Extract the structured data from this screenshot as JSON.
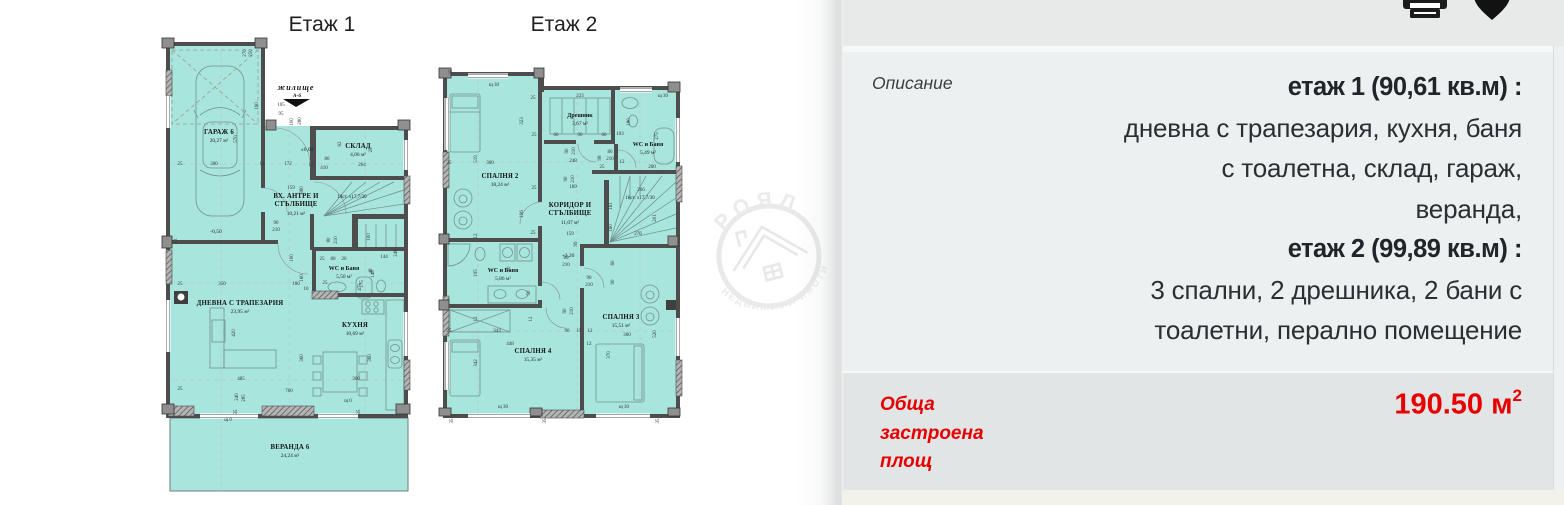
{
  "titles": {
    "floor1": "Етаж 1",
    "floor2": "Етаж 2"
  },
  "watermark": {
    "top_text": "РОЯЛ",
    "bottom_text": "НЕДВИЖИМИ ИМОТИ"
  },
  "toolbar": {
    "icons": [
      "printer-icon",
      "heart-icon"
    ]
  },
  "colors": {
    "room_fill": "#a7e5dd",
    "wall": "#4d4d4d",
    "accent_red": "#e60000"
  },
  "description": {
    "label": "Описание",
    "lines": [
      {
        "text": "етаж 1 (90,61 кв.м) :",
        "bold": true
      },
      {
        "text": "дневна с трапезария, кухня, баня",
        "bold": false
      },
      {
        "text": "с тоалетна, склад, гараж,",
        "bold": false
      },
      {
        "text": "веранда,",
        "bold": false
      },
      {
        "text": "етаж 2 (99,89 кв.м) :",
        "bold": true
      },
      {
        "text": "3 спални, 2 дрешника, 2 бани с",
        "bold": false
      },
      {
        "text": "тоалетни, перално помещение",
        "bold": false
      }
    ]
  },
  "total_area": {
    "label_lines": [
      "Обща",
      "застроена",
      "площ"
    ],
    "value": "190.50 м",
    "sup": "2"
  },
  "floorplans": {
    "floor1": {
      "rooms": [
        {
          "name": "ГАРАЖ 6",
          "area": "20,27 м²",
          "x": 219,
          "y": 134
        },
        {
          "name": "СКЛАД",
          "area": "4,06 м²",
          "x": 358,
          "y": 148
        },
        {
          "name": "ВХ. АНТРЕ И",
          "name2": "СТЪЛБИЩЕ",
          "area": "10,21 м²",
          "x": 296,
          "y": 198
        },
        {
          "name": "WC и Баня",
          "area": "5,50 м²",
          "small": true,
          "x": 344,
          "y": 270
        },
        {
          "name": "ДНЕВНА С ТРАПЕЗАРИЯ",
          "area": "23,95 м²",
          "x": 240,
          "y": 305
        },
        {
          "name": "КУХНЯ",
          "area": "10,69 м²",
          "x": 355,
          "y": 327
        },
        {
          "name": "ВЕРАНДА 6",
          "area": "24,24 м²",
          "x": 290,
          "y": 449
        }
      ],
      "notes": [
        {
          "t": "жилище",
          "x": 296,
          "y": 90,
          "s": "note-b"
        },
        {
          "t": "А-6",
          "x": 297,
          "y": 97,
          "s": "note-b2"
        },
        {
          "t": "±0,00",
          "x": 307,
          "y": 151,
          "s": "lvl"
        },
        {
          "t": "-0,50",
          "x": 216,
          "y": 233,
          "s": "lvl"
        },
        {
          "t": "18ст. x17,7/30",
          "x": 352,
          "y": 198,
          "s": "st"
        },
        {
          "t": "щ 0",
          "x": 348,
          "y": 402,
          "s": "dim"
        },
        {
          "t": "щ 0",
          "x": 228,
          "y": 421,
          "s": "dim"
        }
      ],
      "dims": [
        {
          "t": "270",
          "x": 246,
          "y": 53,
          "r": -90
        },
        {
          "t": "250",
          "x": 252,
          "y": 53,
          "r": -90
        },
        {
          "t": "190",
          "x": 258,
          "y": 106,
          "r": -90
        },
        {
          "t": "105",
          "x": 281,
          "y": 106
        },
        {
          "t": "95",
          "x": 281,
          "y": 115
        },
        {
          "t": "100",
          "x": 293,
          "y": 122,
          "r": -90
        },
        {
          "t": "280",
          "x": 301,
          "y": 121,
          "r": -90
        },
        {
          "t": "570",
          "x": 237,
          "y": 139,
          "r": -90
        },
        {
          "t": "25",
          "x": 180,
          "y": 165
        },
        {
          "t": "300",
          "x": 214,
          "y": 165
        },
        {
          "t": "12",
          "x": 262,
          "y": 165
        },
        {
          "t": "172",
          "x": 288,
          "y": 165
        },
        {
          "t": "12",
          "x": 311,
          "y": 166
        },
        {
          "t": "410",
          "x": 324,
          "y": 169
        },
        {
          "t": "80",
          "x": 327,
          "y": 160
        },
        {
          "t": "264",
          "x": 362,
          "y": 166
        },
        {
          "t": "62",
          "x": 341,
          "y": 144,
          "r": -90
        },
        {
          "t": "25",
          "x": 372,
          "y": 150,
          "r": -90
        },
        {
          "t": "159",
          "x": 291,
          "y": 189
        },
        {
          "t": "380",
          "x": 303,
          "y": 190,
          "r": -90
        },
        {
          "t": "90",
          "x": 276,
          "y": 224
        },
        {
          "t": "210",
          "x": 276,
          "y": 231
        },
        {
          "t": "80",
          "x": 330,
          "y": 240,
          "r": -90
        },
        {
          "t": "210",
          "x": 337,
          "y": 240,
          "r": -90
        },
        {
          "t": "100",
          "x": 370,
          "y": 237,
          "r": -90
        },
        {
          "t": "248",
          "x": 397,
          "y": 253,
          "r": -90
        },
        {
          "t": "25",
          "x": 322,
          "y": 260
        },
        {
          "t": "80",
          "x": 333,
          "y": 260
        },
        {
          "t": "26",
          "x": 344,
          "y": 260
        },
        {
          "t": "144",
          "x": 384,
          "y": 258
        },
        {
          "t": "48",
          "x": 372,
          "y": 271,
          "r": -90
        },
        {
          "t": "175",
          "x": 363,
          "y": 284,
          "r": -90
        },
        {
          "t": "475",
          "x": 361,
          "y": 287,
          "r": -90
        },
        {
          "t": "148",
          "x": 374,
          "y": 274,
          "r": -90
        },
        {
          "t": "25",
          "x": 325,
          "y": 284
        },
        {
          "t": "25",
          "x": 180,
          "y": 285
        },
        {
          "t": "350",
          "x": 222,
          "y": 285
        },
        {
          "t": "100",
          "x": 296,
          "y": 285
        },
        {
          "t": "10",
          "x": 306,
          "y": 290
        },
        {
          "t": "100",
          "x": 293,
          "y": 258,
          "r": -90
        },
        {
          "t": "160",
          "x": 303,
          "y": 278,
          "r": -90
        },
        {
          "t": "420",
          "x": 235,
          "y": 333,
          "r": -90
        },
        {
          "t": "360",
          "x": 303,
          "y": 358,
          "r": -90
        },
        {
          "t": "360",
          "x": 371,
          "y": 358,
          "r": -90
        },
        {
          "t": "485",
          "x": 241,
          "y": 380
        },
        {
          "t": "300",
          "x": 356,
          "y": 380
        },
        {
          "t": "760",
          "x": 289,
          "y": 392
        },
        {
          "t": "240",
          "x": 238,
          "y": 397,
          "r": -90
        },
        {
          "t": "285",
          "x": 245,
          "y": 398,
          "r": -90
        },
        {
          "t": "25",
          "x": 180,
          "y": 390
        },
        {
          "t": "35",
          "x": 237,
          "y": 412,
          "r": -90
        },
        {
          "t": "35",
          "x": 360,
          "y": 412,
          "r": -90
        },
        {
          "t": "12",
          "x": 177,
          "y": 241,
          "r": -90
        }
      ]
    },
    "floor2": {
      "rooms": [
        {
          "name": "СПАЛНЯ 2",
          "area": "18,24 м²",
          "x": 500,
          "y": 178
        },
        {
          "name": "Дрешник",
          "area": "3,67 м²",
          "small": true,
          "x": 580,
          "y": 117
        },
        {
          "name": "WC и Баня",
          "area": "5,49 м²",
          "small": true,
          "x": 648,
          "y": 146
        },
        {
          "name": "КОРИДОР И",
          "name2": "СТЪЛБИЩЕ",
          "area": "11,07 м²",
          "x": 570,
          "y": 207
        },
        {
          "name": "WC и Баня",
          "area": "5,86 м²",
          "small": true,
          "x": 503,
          "y": 272
        },
        {
          "name": "СПАЛНЯ 3",
          "area": "15,51 м²",
          "x": 621,
          "y": 319
        },
        {
          "name": "СПАЛНЯ 4",
          "area": "15,35 м²",
          "x": 533,
          "y": 353
        }
      ],
      "notes": [
        {
          "t": "18ст. x17,7/30",
          "x": 640,
          "y": 199,
          "s": "st"
        },
        {
          "t": "+3,20",
          "x": 568,
          "y": 257,
          "s": "lvl"
        },
        {
          "t": "щ 30",
          "x": 494,
          "y": 86,
          "s": "dim"
        },
        {
          "t": "щ 30",
          "x": 663,
          "y": 97,
          "s": "dim"
        },
        {
          "t": "щ 30",
          "x": 503,
          "y": 408,
          "s": "dim"
        },
        {
          "t": "щ 30",
          "x": 624,
          "y": 408,
          "s": "dim"
        }
      ],
      "dims": [
        {
          "t": "35",
          "x": 452,
          "y": 72,
          "r": -90
        },
        {
          "t": "25",
          "x": 533,
          "y": 99
        },
        {
          "t": "223",
          "x": 580,
          "y": 97
        },
        {
          "t": "323",
          "x": 523,
          "y": 121,
          "r": -90
        },
        {
          "t": "66",
          "x": 556,
          "y": 136
        },
        {
          "t": "90",
          "x": 580,
          "y": 136
        },
        {
          "t": "66",
          "x": 604,
          "y": 136
        },
        {
          "t": "25",
          "x": 534,
          "y": 136
        },
        {
          "t": "180",
          "x": 630,
          "y": 122,
          "r": -90
        },
        {
          "t": "103",
          "x": 620,
          "y": 135
        },
        {
          "t": "275",
          "x": 658,
          "y": 136,
          "r": -90
        },
        {
          "t": "519",
          "x": 477,
          "y": 159,
          "r": -90
        },
        {
          "t": "25",
          "x": 449,
          "y": 164
        },
        {
          "t": "300",
          "x": 490,
          "y": 164
        },
        {
          "t": "248",
          "x": 573,
          "y": 162
        },
        {
          "t": "90",
          "x": 568,
          "y": 151,
          "r": -90
        },
        {
          "t": "210",
          "x": 575,
          "y": 151,
          "r": -90
        },
        {
          "t": "80",
          "x": 610,
          "y": 153
        },
        {
          "t": "210",
          "x": 610,
          "y": 160
        },
        {
          "t": "12",
          "x": 622,
          "y": 163
        },
        {
          "t": "98",
          "x": 601,
          "y": 158,
          "r": -90
        },
        {
          "t": "200",
          "x": 652,
          "y": 168
        },
        {
          "t": "25",
          "x": 602,
          "y": 168
        },
        {
          "t": "196",
          "x": 523,
          "y": 214,
          "r": -90
        },
        {
          "t": "25",
          "x": 534,
          "y": 189
        },
        {
          "t": "189",
          "x": 573,
          "y": 188
        },
        {
          "t": "90",
          "x": 567,
          "y": 179,
          "r": -90
        },
        {
          "t": "210",
          "x": 574,
          "y": 179,
          "r": -90
        },
        {
          "t": "266",
          "x": 641,
          "y": 191
        },
        {
          "t": "161",
          "x": 612,
          "y": 206,
          "r": -90
        },
        {
          "t": "160",
          "x": 612,
          "y": 228,
          "r": -90
        },
        {
          "t": "276",
          "x": 638,
          "y": 235
        },
        {
          "t": "201",
          "x": 656,
          "y": 218,
          "r": -90
        },
        {
          "t": "12",
          "x": 477,
          "y": 236,
          "r": -90
        },
        {
          "t": "25",
          "x": 533,
          "y": 234
        },
        {
          "t": "159",
          "x": 570,
          "y": 235
        },
        {
          "t": "99",
          "x": 577,
          "y": 244,
          "r": -90
        },
        {
          "t": "195",
          "x": 477,
          "y": 273,
          "r": -90
        },
        {
          "t": "80",
          "x": 510,
          "y": 269,
          "r": -90
        },
        {
          "t": "80",
          "x": 566,
          "y": 259
        },
        {
          "t": "210",
          "x": 566,
          "y": 266
        },
        {
          "t": "90",
          "x": 589,
          "y": 279
        },
        {
          "t": "210",
          "x": 589,
          "y": 286
        },
        {
          "t": "60",
          "x": 614,
          "y": 263,
          "r": -90
        },
        {
          "t": "90",
          "x": 614,
          "y": 282,
          "r": -90
        },
        {
          "t": "50",
          "x": 530,
          "y": 293,
          "r": -90
        },
        {
          "t": "90",
          "x": 566,
          "y": 311,
          "r": -90
        },
        {
          "t": "210",
          "x": 573,
          "y": 311,
          "r": -90
        },
        {
          "t": "12",
          "x": 477,
          "y": 319,
          "r": -90
        },
        {
          "t": "12",
          "x": 532,
          "y": 319,
          "r": -90
        },
        {
          "t": "25",
          "x": 449,
          "y": 332
        },
        {
          "t": "343",
          "x": 497,
          "y": 332
        },
        {
          "t": "90",
          "x": 567,
          "y": 332
        },
        {
          "t": "15",
          "x": 579,
          "y": 332
        },
        {
          "t": "12",
          "x": 590,
          "y": 332
        },
        {
          "t": "448",
          "x": 510,
          "y": 345
        },
        {
          "t": "12",
          "x": 589,
          "y": 345
        },
        {
          "t": "300",
          "x": 627,
          "y": 336
        },
        {
          "t": "520",
          "x": 656,
          "y": 334,
          "r": -90
        },
        {
          "t": "370",
          "x": 610,
          "y": 355,
          "r": -90
        },
        {
          "t": "342",
          "x": 477,
          "y": 363,
          "r": -90
        },
        {
          "t": "35",
          "x": 453,
          "y": 421,
          "r": -90
        },
        {
          "t": "35",
          "x": 546,
          "y": 421,
          "r": -90
        },
        {
          "t": "35",
          "x": 659,
          "y": 421,
          "r": -90
        }
      ]
    }
  }
}
